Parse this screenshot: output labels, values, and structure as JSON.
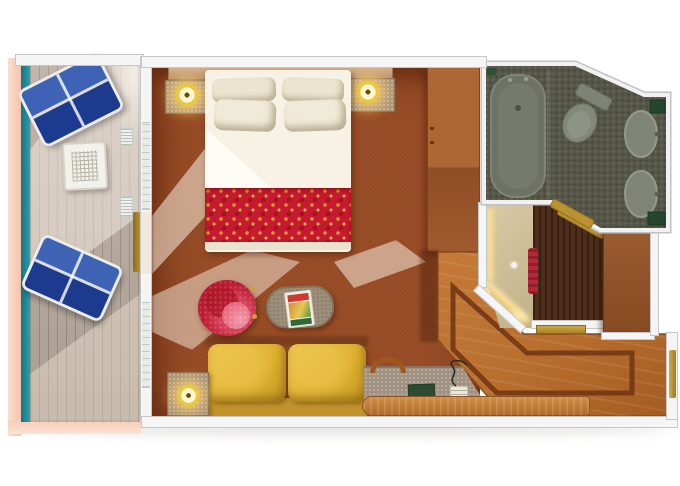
{
  "meta": {
    "title": "Cruise ship balcony stateroom floor plan — top-down 3D render",
    "canvas_width": 680,
    "canvas_height": 486
  },
  "colors": {
    "carpet": "#9c4f28",
    "deck": "#b6a89b",
    "teal": "#1f8e9e",
    "salmon": "#f5c2aa",
    "wall": "#f5f5f5",
    "wall-line": "#c7c7c7",
    "wood": "#b96f2e",
    "inlay": "#6f3413",
    "bathfloor": "#555649",
    "fixture": "#7d8476",
    "green": "#2d4f37",
    "duvet": "#f7f2e4",
    "pillow": "#ece4d0",
    "runner": "#c51a30",
    "sofa": "#ddb02f",
    "chair": "#bc1d33",
    "taupe": "#9e8f7a",
    "lamp": "#e8c646",
    "gold": "#b8932e",
    "dark-closet": "#4e2e1b",
    "beige-closet": "#cdbd97",
    "glow": "#ffe9b2",
    "lounger": "#2d4da0"
  },
  "rooms": {
    "balcony": {
      "label": "Private balcony with plank deck and railing"
    },
    "bedroom": {
      "label": "Stateroom sleeping and sitting area with terracotta carpet"
    },
    "bathroom": {
      "label": "Bathroom with bathtub, toilet and two washbasins"
    },
    "entry": {
      "label": "Entry hallway with inlaid wood floor"
    },
    "closet": {
      "label": "Closet and dressing area with lighted wall"
    }
  },
  "furniture": {
    "lounger": "Blue sun lounger",
    "balcony_table": "White mesh side table",
    "rail": "Teal balcony railing",
    "vent": "Deck vent grille",
    "sliding_door": "Sliding glass balcony door",
    "window": "Balcony window",
    "bed": "Bed with white duvet and red patterned runner",
    "pillow": "Pillow",
    "headboard": "Headboard shelf",
    "nightstand": "Nightstand",
    "lamp": "Gold table lamp",
    "wardrobe": "Wardrobe cabinet",
    "armchair": "Red tub chair",
    "coffee_table": "Oval coffee table",
    "magazine": "Magazine",
    "sofa": "Yellow two-seat sofa",
    "side_table": "Side table with lamp",
    "desk": "Vanity desk",
    "book": "Green folder",
    "phone": "Telephone with cord",
    "towel_arch": "Curved wood rail",
    "desk_shelf": "Wood vanity counter front",
    "floor_inlay": "Dark wood inlay border",
    "entry_door": "Gold cabin entry door",
    "threshold": "Gold door threshold",
    "bathtub": "Bathtub",
    "toilet": "Toilet",
    "sink": "Washbasin",
    "vanity": "Green vanity counter",
    "bathroom_door": "Gold bathroom door",
    "garment": "Red hanging garment",
    "glow_wall": "Illuminated closet wall",
    "knob": "Closet door knob"
  }
}
